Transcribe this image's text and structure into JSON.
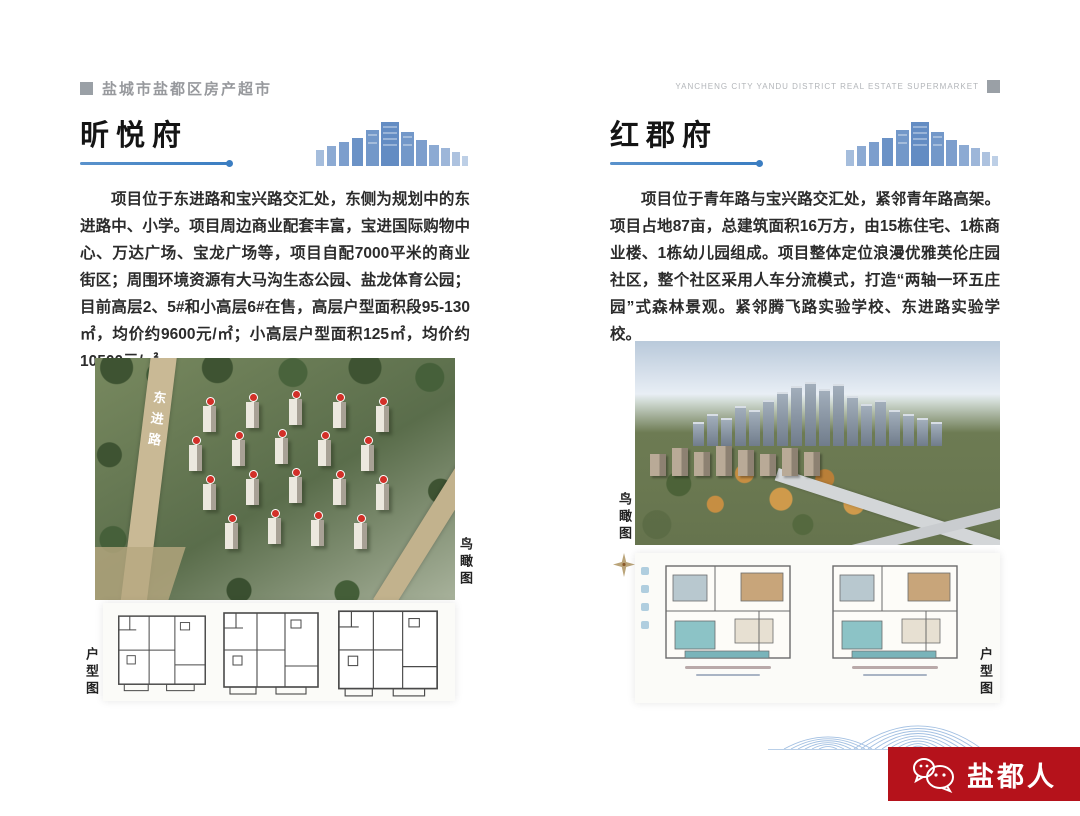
{
  "header": {
    "left_title": "盐城市盐都区房产超市",
    "right_title": "YANCHENG CITY YANDU DISTRICT REAL ESTATE SUPERMARKET"
  },
  "listings": [
    {
      "name": "昕悦府",
      "description": "项目位于东进路和宝兴路交汇处，东侧为规划中的东进路中、小学。项目周边商业配套丰富，宝进国际购物中心、万达广场、宝龙广场等，项目自配7000平米的商业街区；周围环境资源有大马沟生态公园、盐龙体育公园；目前高层2、5#和小高层6#在售，高层户型面积段95-130㎡，均价约9600元/㎡；小高层户型面积125㎡，均价约10500元/㎡。",
      "phone_line": "咨询电话：0515-8886 9888",
      "aerial_label": "鸟瞰图",
      "floorplan_label": "户型图",
      "road_labels": [
        "东进路",
        "宝兴路"
      ]
    },
    {
      "name": "红郡府",
      "description": "项目位于青年路与宝兴路交汇处，紧邻青年路高架。项目占地87亩，总建筑面积16万方，由15栋住宅、1栋商业楼、1栋幼儿园组成。项目整体定位浪漫优雅英伦庄园社区，整个社区采用人车分流模式，打造“两轴一环五庄园”式森林景观。紧邻腾飞路实验学校、东进路实验学校。",
      "phone_line": "咨询电话：0515-8089 0000",
      "aerial_label": "鸟瞰图",
      "floorplan_label": "户型图"
    }
  ],
  "footer": {
    "brand": "盐都人"
  },
  "colors": {
    "accent_blue": "#3b7ec2",
    "brand_red": "#b5121b",
    "header_gray": "#9aa0a6"
  },
  "icons": {
    "header_marker": "gray-square",
    "title_skyline": "city-skyline",
    "aerial_compass": "compass-rose",
    "brand_logo": "wechat-bubbles"
  }
}
